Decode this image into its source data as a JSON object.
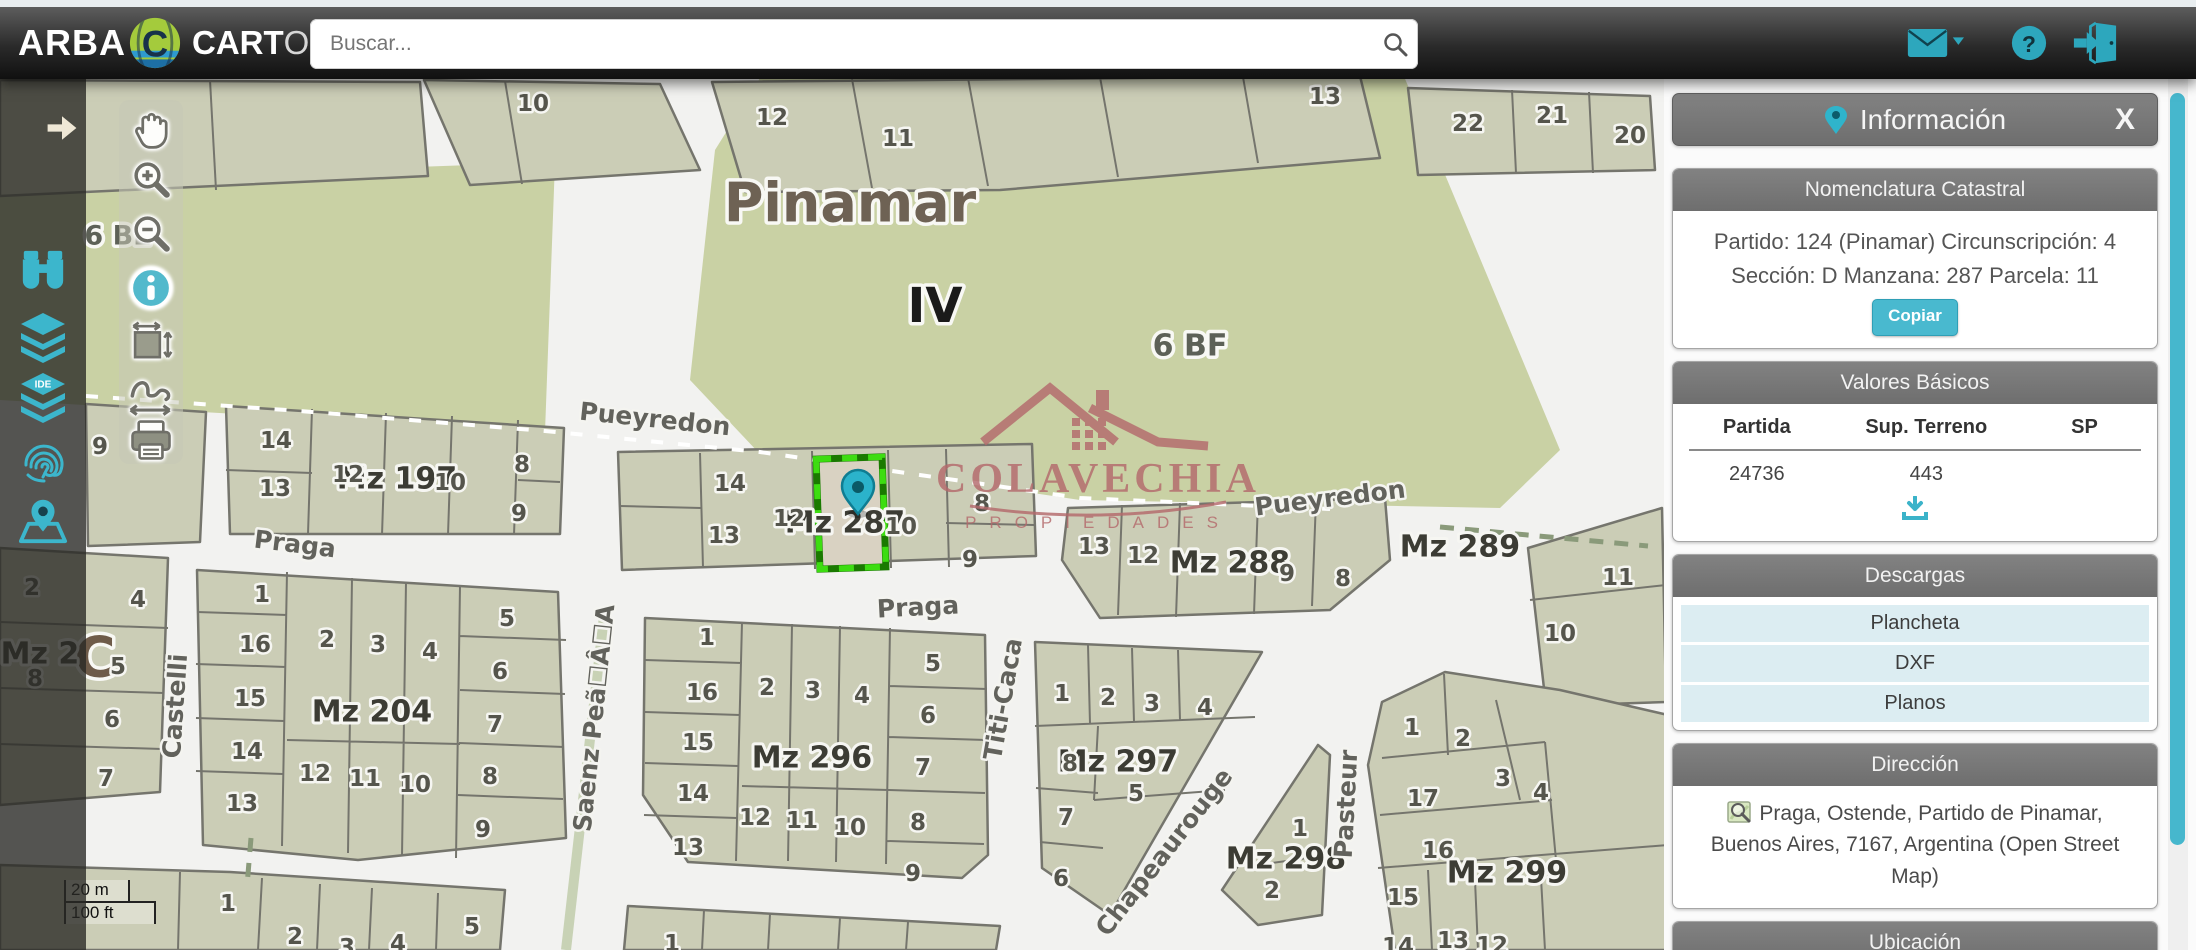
{
  "topbar": {
    "brand": "ARBA",
    "logo_bold": "CART",
    "logo_light": "O",
    "search_placeholder": "Buscar...",
    "accent": "#2da7bd"
  },
  "map": {
    "scale_m": "20 m",
    "scale_ft": "100 ft",
    "watermark": {
      "line1": "COLAVECHIA",
      "line2": "PROPIEDADES"
    },
    "zone_labels": [
      {
        "t": "Pinamar",
        "x": 850,
        "y": 203,
        "s": 54,
        "c": "#6e6254"
      },
      {
        "t": "IV",
        "x": 935,
        "y": 306,
        "s": 48,
        "c": "#1a1a1a"
      },
      {
        "t": "6 BF",
        "x": 1190,
        "y": 346,
        "s": 30,
        "c": "#5d6157"
      },
      {
        "t": "6 BE",
        "x": 118,
        "y": 236,
        "s": 27,
        "c": "#5d6157"
      },
      {
        "t": "C",
        "x": 95,
        "y": 658,
        "s": 56,
        "c": "#6e5b49"
      }
    ],
    "mz_labels": [
      {
        "t": "Mz 197",
        "x": 397,
        "y": 479
      },
      {
        "t": "Mz 287",
        "x": 845,
        "y": 523
      },
      {
        "t": "Mz 288",
        "x": 1230,
        "y": 563
      },
      {
        "t": "Mz 289",
        "x": 1460,
        "y": 547
      },
      {
        "t": "Mz 296",
        "x": 812,
        "y": 758
      },
      {
        "t": "Mz 204",
        "x": 372,
        "y": 712
      },
      {
        "t": "Mz 297",
        "x": 1118,
        "y": 762
      },
      {
        "t": "Mz 298",
        "x": 1286,
        "y": 859
      },
      {
        "t": "Mz 299",
        "x": 1507,
        "y": 873
      },
      {
        "t": "Mz 2",
        "x": 40,
        "y": 654
      }
    ],
    "street_labels": [
      {
        "t": "Pueyredon",
        "x": 655,
        "y": 419,
        "r": 6
      },
      {
        "t": "Pueyredon",
        "x": 1330,
        "y": 498,
        "r": -7
      },
      {
        "t": "Praga",
        "x": 295,
        "y": 544,
        "r": 7
      },
      {
        "t": "Praga",
        "x": 918,
        "y": 607,
        "r": -3
      },
      {
        "t": "Castelli",
        "x": 175,
        "y": 706,
        "r": -86
      },
      {
        "t": "Saenz Peã☐Â☐A",
        "x": 594,
        "y": 718,
        "r": -84
      },
      {
        "t": "Titi-Caca",
        "x": 1003,
        "y": 699,
        "r": -80
      },
      {
        "t": "Chapeaurouge",
        "x": 1164,
        "y": 852,
        "r": -52
      },
      {
        "t": "Pasteur",
        "x": 1346,
        "y": 804,
        "r": -87
      }
    ],
    "parcel_labels": [
      {
        "t": "10",
        "x": 533,
        "y": 104
      },
      {
        "t": "12",
        "x": 772,
        "y": 118
      },
      {
        "t": "11",
        "x": 898,
        "y": 139
      },
      {
        "t": "13",
        "x": 1325,
        "y": 97
      },
      {
        "t": "22",
        "x": 1468,
        "y": 124
      },
      {
        "t": "21",
        "x": 1552,
        "y": 116
      },
      {
        "t": "20",
        "x": 1630,
        "y": 136
      },
      {
        "t": "14",
        "x": 276,
        "y": 441
      },
      {
        "t": "13",
        "x": 275,
        "y": 489
      },
      {
        "t": "12",
        "x": 348,
        "y": 475
      },
      {
        "t": "10",
        "x": 450,
        "y": 483
      },
      {
        "t": "8",
        "x": 522,
        "y": 465
      },
      {
        "t": "9",
        "x": 519,
        "y": 514
      },
      {
        "t": "14",
        "x": 730,
        "y": 484
      },
      {
        "t": "13",
        "x": 724,
        "y": 536
      },
      {
        "t": "12",
        "x": 789,
        "y": 519
      },
      {
        "t": "10",
        "x": 901,
        "y": 527
      },
      {
        "t": "8",
        "x": 982,
        "y": 504
      },
      {
        "t": "9",
        "x": 970,
        "y": 560
      },
      {
        "t": "13",
        "x": 1094,
        "y": 547
      },
      {
        "t": "12",
        "x": 1143,
        "y": 556
      },
      {
        "t": "9",
        "x": 1287,
        "y": 574
      },
      {
        "t": "8",
        "x": 1343,
        "y": 579
      },
      {
        "t": "11",
        "x": 1618,
        "y": 578
      },
      {
        "t": "10",
        "x": 1560,
        "y": 634
      },
      {
        "t": "9",
        "x": 100,
        "y": 447
      },
      {
        "t": "1",
        "x": 707,
        "y": 638
      },
      {
        "t": "16",
        "x": 702,
        "y": 693
      },
      {
        "t": "15",
        "x": 698,
        "y": 743
      },
      {
        "t": "14",
        "x": 693,
        "y": 794
      },
      {
        "t": "13",
        "x": 688,
        "y": 848
      },
      {
        "t": "2",
        "x": 767,
        "y": 688
      },
      {
        "t": "3",
        "x": 813,
        "y": 691
      },
      {
        "t": "4",
        "x": 862,
        "y": 696
      },
      {
        "t": "5",
        "x": 933,
        "y": 664
      },
      {
        "t": "6",
        "x": 928,
        "y": 716
      },
      {
        "t": "7",
        "x": 923,
        "y": 768
      },
      {
        "t": "8",
        "x": 918,
        "y": 823
      },
      {
        "t": "9",
        "x": 913,
        "y": 874
      },
      {
        "t": "12",
        "x": 755,
        "y": 818
      },
      {
        "t": "11",
        "x": 802,
        "y": 821
      },
      {
        "t": "10",
        "x": 850,
        "y": 828
      },
      {
        "t": "1",
        "x": 262,
        "y": 595
      },
      {
        "t": "16",
        "x": 255,
        "y": 645
      },
      {
        "t": "15",
        "x": 250,
        "y": 699
      },
      {
        "t": "14",
        "x": 247,
        "y": 752
      },
      {
        "t": "13",
        "x": 242,
        "y": 804
      },
      {
        "t": "2",
        "x": 327,
        "y": 640
      },
      {
        "t": "3",
        "x": 378,
        "y": 645
      },
      {
        "t": "4",
        "x": 430,
        "y": 652
      },
      {
        "t": "5",
        "x": 507,
        "y": 619
      },
      {
        "t": "6",
        "x": 500,
        "y": 672
      },
      {
        "t": "7",
        "x": 495,
        "y": 725
      },
      {
        "t": "8",
        "x": 490,
        "y": 777
      },
      {
        "t": "9",
        "x": 483,
        "y": 830
      },
      {
        "t": "12",
        "x": 315,
        "y": 774
      },
      {
        "t": "11",
        "x": 365,
        "y": 779
      },
      {
        "t": "10",
        "x": 415,
        "y": 785
      },
      {
        "t": "4",
        "x": 138,
        "y": 600
      },
      {
        "t": "5",
        "x": 118,
        "y": 667
      },
      {
        "t": "6",
        "x": 112,
        "y": 720
      },
      {
        "t": "7",
        "x": 106,
        "y": 779
      },
      {
        "t": "2",
        "x": 32,
        "y": 588
      },
      {
        "t": "8",
        "x": 35,
        "y": 679
      },
      {
        "t": "1",
        "x": 228,
        "y": 904
      },
      {
        "t": "2",
        "x": 295,
        "y": 937
      },
      {
        "t": "3",
        "x": 347,
        "y": 948
      },
      {
        "t": "4",
        "x": 398,
        "y": 944
      },
      {
        "t": "5",
        "x": 472,
        "y": 927
      },
      {
        "t": "1",
        "x": 672,
        "y": 944
      },
      {
        "t": "1",
        "x": 1062,
        "y": 694
      },
      {
        "t": "2",
        "x": 1108,
        "y": 698
      },
      {
        "t": "3",
        "x": 1152,
        "y": 704
      },
      {
        "t": "4",
        "x": 1205,
        "y": 708
      },
      {
        "t": "8",
        "x": 1070,
        "y": 764
      },
      {
        "t": "5",
        "x": 1136,
        "y": 794
      },
      {
        "t": "7",
        "x": 1066,
        "y": 818
      },
      {
        "t": "6",
        "x": 1061,
        "y": 879
      },
      {
        "t": "1",
        "x": 1300,
        "y": 829
      },
      {
        "t": "2",
        "x": 1272,
        "y": 891
      },
      {
        "t": "1",
        "x": 1412,
        "y": 728
      },
      {
        "t": "2",
        "x": 1463,
        "y": 739
      },
      {
        "t": "3",
        "x": 1503,
        "y": 779
      },
      {
        "t": "4",
        "x": 1541,
        "y": 793
      },
      {
        "t": "17",
        "x": 1423,
        "y": 799
      },
      {
        "t": "16",
        "x": 1438,
        "y": 851
      },
      {
        "t": "15",
        "x": 1403,
        "y": 898
      },
      {
        "t": "13",
        "x": 1453,
        "y": 941
      },
      {
        "t": "14",
        "x": 1398,
        "y": 947
      },
      {
        "t": "12",
        "x": 1492,
        "y": 946
      }
    ]
  },
  "panel": {
    "title": "Información",
    "close": "X",
    "nomenclatura": {
      "title": "Nomenclatura Catastral",
      "line1": "Partido: 124 (Pinamar) Circunscripción: 4",
      "line2": "Sección: D Manzana: 287 Parcela: 11",
      "copy": "Copiar"
    },
    "valores": {
      "title": "Valores Básicos",
      "columns": [
        "Partida",
        "Sup. Terreno",
        "SP"
      ],
      "rows": [
        [
          "24736",
          "443",
          ""
        ]
      ]
    },
    "descargas": {
      "title": "Descargas",
      "items": [
        "Plancheta",
        "DXF",
        "Planos"
      ]
    },
    "direccion": {
      "title": "Dirección",
      "text": "Praga, Ostende, Partido de Pinamar, Buenos Aires, 7167, Argentina (Open Street Map)"
    },
    "ubicacion": {
      "title": "Ubicación"
    }
  }
}
